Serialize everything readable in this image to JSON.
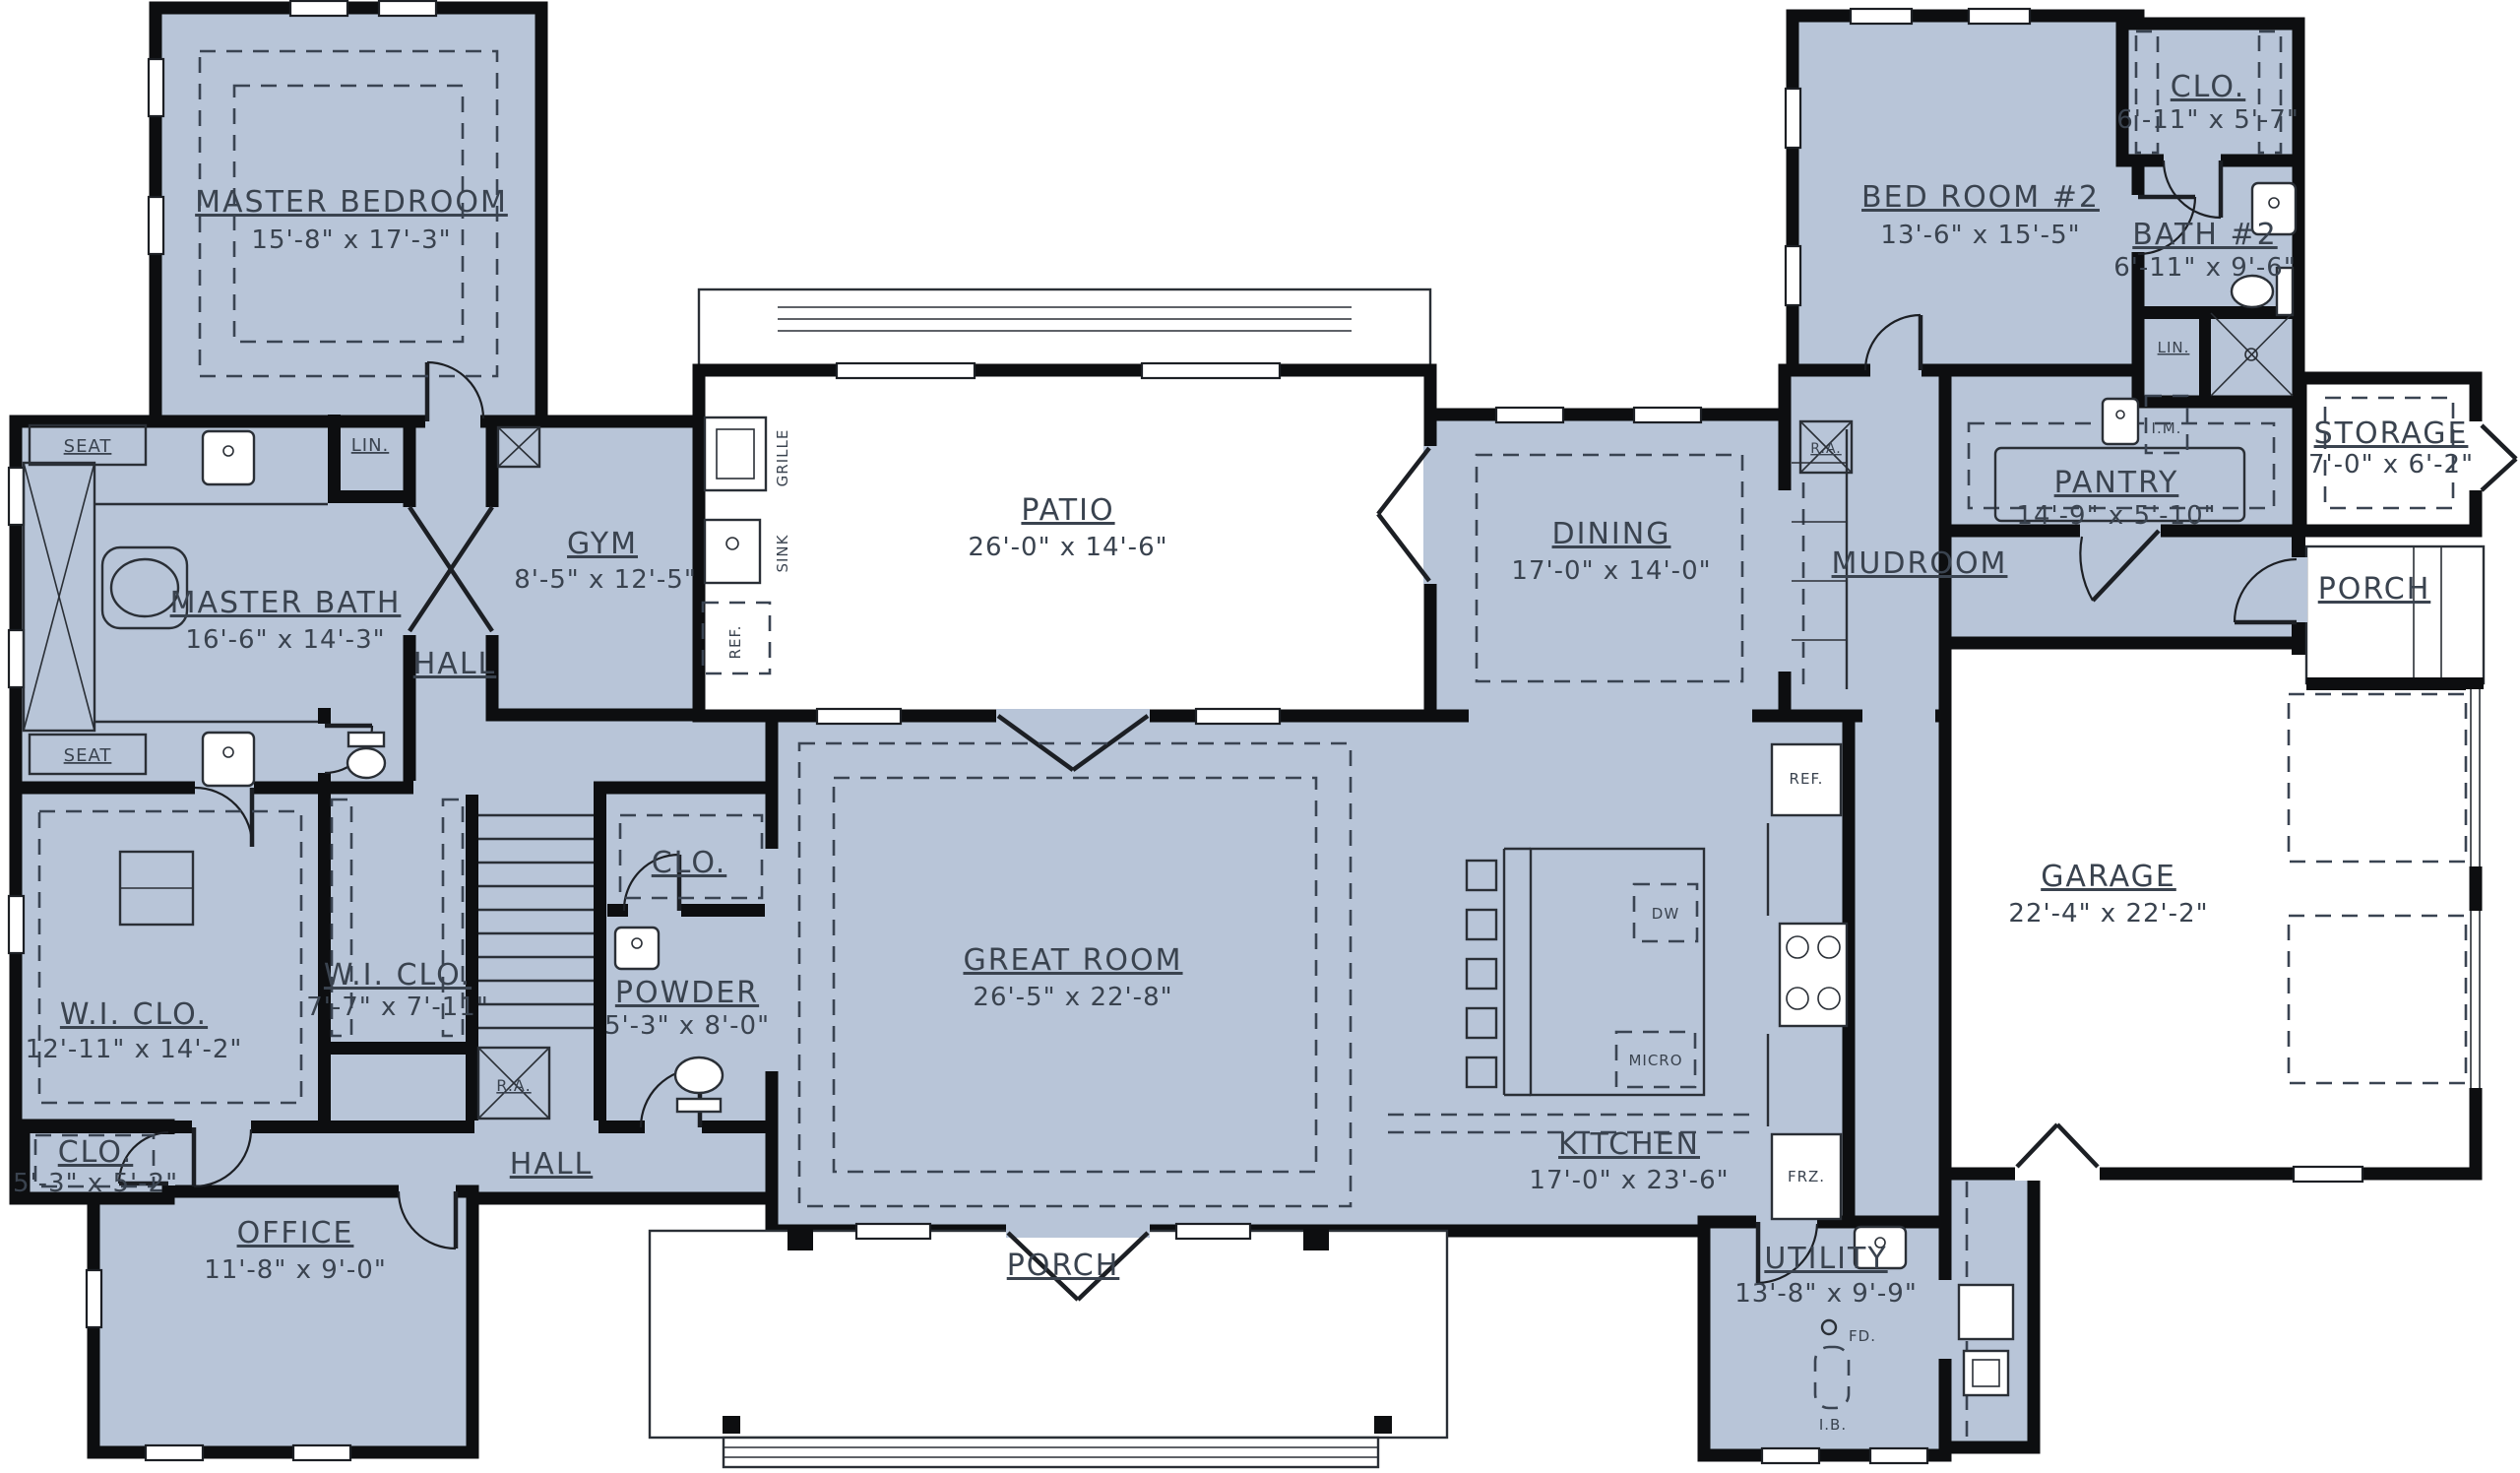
{
  "plan": {
    "colors": {
      "floor_fill": "#b8c5d8",
      "wall": "#0d0e10",
      "background": "#ffffff",
      "text": "#3a434f"
    },
    "rooms": {
      "master_bedroom": {
        "name": "MASTER BEDROOM",
        "dims": "15'-8\" x 17'-3\""
      },
      "master_bath": {
        "name": "MASTER BATH",
        "dims": "16'-6\" x 14'-3\""
      },
      "gym": {
        "name": "GYM",
        "dims": "8'-5\" x 12'-5\""
      },
      "hall_upper": {
        "name": "HALL"
      },
      "hall_lower": {
        "name": "HALL"
      },
      "patio": {
        "name": "PATIO",
        "dims": "26'-0\" x 14'-6\""
      },
      "great_room": {
        "name": "GREAT ROOM",
        "dims": "26'-5\" x 22'-8\""
      },
      "kitchen": {
        "name": "KITCHEN",
        "dims": "17'-0\" x 23'-6\""
      },
      "dining": {
        "name": "DINING",
        "dims": "17'-0\" x 14'-0\""
      },
      "mudroom": {
        "name": "MUDROOM"
      },
      "pantry": {
        "name": "PANTRY",
        "dims": "14'-9\" x 5'-10\""
      },
      "bedroom2": {
        "name": "BED ROOM #2",
        "dims": "13'-6\" x 15'-5\""
      },
      "closet2": {
        "name": "CLO.",
        "dims": "6'-11\" x 5'-7\""
      },
      "bath2": {
        "name": "BATH #2",
        "dims": "6'-11\" x 9'-6\""
      },
      "storage": {
        "name": "STORAGE",
        "dims": "7'-0\" x 6'-2\""
      },
      "porch_right": {
        "name": "PORCH"
      },
      "porch_front": {
        "name": "PORCH"
      },
      "garage": {
        "name": "GARAGE",
        "dims": "22'-4\" x 22'-2\""
      },
      "utility": {
        "name": "UTILITY",
        "dims": "13'-8\" x 9'-9\""
      },
      "office": {
        "name": "OFFICE",
        "dims": "11'-8\" x 9'-0\""
      },
      "wic_master": {
        "name": "W.I. CLO.",
        "dims": "12'-11\" x 14'-2\""
      },
      "wic_hall": {
        "name": "W.I. CLO.",
        "dims": "7'-7\" x 7'-11\""
      },
      "powder": {
        "name": "POWDER",
        "dims": "5'-3\" x 8'-0\""
      },
      "clo_hall": {
        "name": "CLO."
      },
      "clo_office": {
        "name": "CLO.",
        "dims": "5'-3\" x 5'-2\""
      }
    },
    "fixtures": {
      "seat": "SEAT",
      "lin": "LIN.",
      "ra": "R.A.",
      "im": "I.M.",
      "ref": "REF.",
      "dw": "DW",
      "micro": "MICRO",
      "frz": "FRZ.",
      "grille": "GRILLE",
      "sink": "SINK",
      "fd": "FD.",
      "ib": "I.B."
    }
  }
}
